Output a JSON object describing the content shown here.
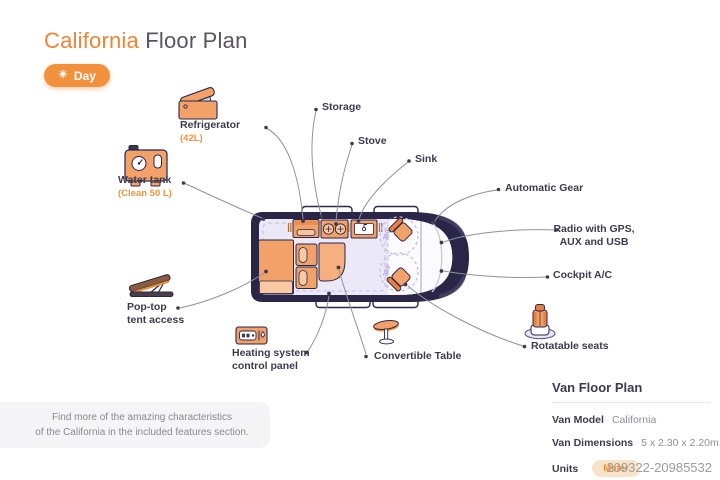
{
  "header": {
    "title_accent": "California",
    "title_rest": " Floor Plan",
    "day_button": "Day",
    "sun_icon": "☀"
  },
  "features": {
    "refrigerator": {
      "label": "Refrigerator",
      "sub": "(42L)"
    },
    "water_tank": {
      "label": "Water tank",
      "sub": "(Clean 50 L)"
    },
    "storage": {
      "label": "Storage"
    },
    "stove": {
      "label": "Stove"
    },
    "sink": {
      "label": "Sink"
    },
    "automatic_gear": {
      "label": "Automatic Gear"
    },
    "radio": {
      "label": "Radio with GPS,\nAUX and USB"
    },
    "cockpit_ac": {
      "label": "Cockpit A/C"
    },
    "rotatable_seats": {
      "label": "Rotatable seats"
    },
    "convertible_table": {
      "label": "Convertible Table"
    },
    "heating": {
      "label": "Heating system\ncontrol panel"
    },
    "pop_top": {
      "label": "Pop-top\ntent access"
    }
  },
  "diagram": {
    "rotation_label_front": "360°",
    "rotation_label_rear": "360°"
  },
  "note": {
    "text": "Find more of the amazing characteristics\nof the California in the included features section."
  },
  "info_panel": {
    "heading": "Van Floor Plan",
    "rows": [
      {
        "label": "Van Model",
        "value": "California"
      },
      {
        "label": "Van Dimensions",
        "value": "5 x 2.30 x 2.20m"
      },
      {
        "label": "Units",
        "value": "Meter"
      }
    ]
  },
  "watermark": "209322-20985532",
  "colors": {
    "accent": "#EE8434",
    "van_body": "#2A2647",
    "interior": "#EBE8F8",
    "furniture": "#F2A269",
    "leader_line": "#93909F"
  }
}
